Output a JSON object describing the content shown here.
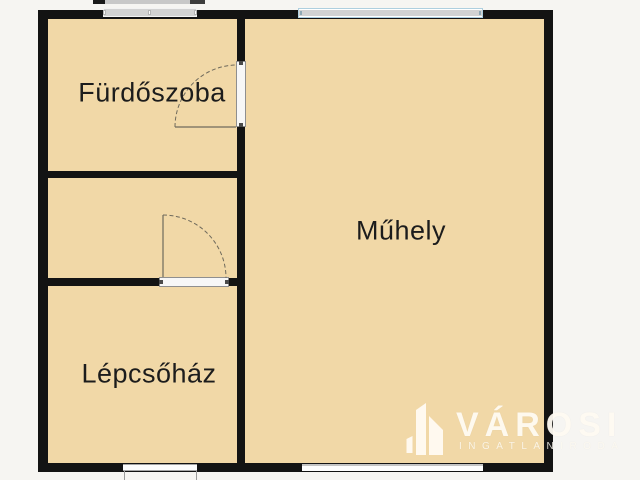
{
  "floorplan": {
    "rooms": [
      {
        "id": "furdoszoba",
        "label": "Fürdőszoba"
      },
      {
        "id": "muhely",
        "label": "Műhely"
      },
      {
        "id": "lepcsohaz",
        "label": "Lépcsőház"
      }
    ],
    "features": {
      "doors": 2,
      "windows_top": 2,
      "openings_bottom": 2
    },
    "colors": {
      "background": "#f6f5f2",
      "room_fill": "#f1d8a7",
      "wall": "#131313",
      "window_glass": "#d2d2d2",
      "window2_frame": "#aecfdf",
      "label_color": "#1c1c1c"
    }
  },
  "watermark": {
    "brand": "VÁROSI",
    "subtitle": "INGATLANIRODA",
    "icon": "buildings-icon"
  }
}
